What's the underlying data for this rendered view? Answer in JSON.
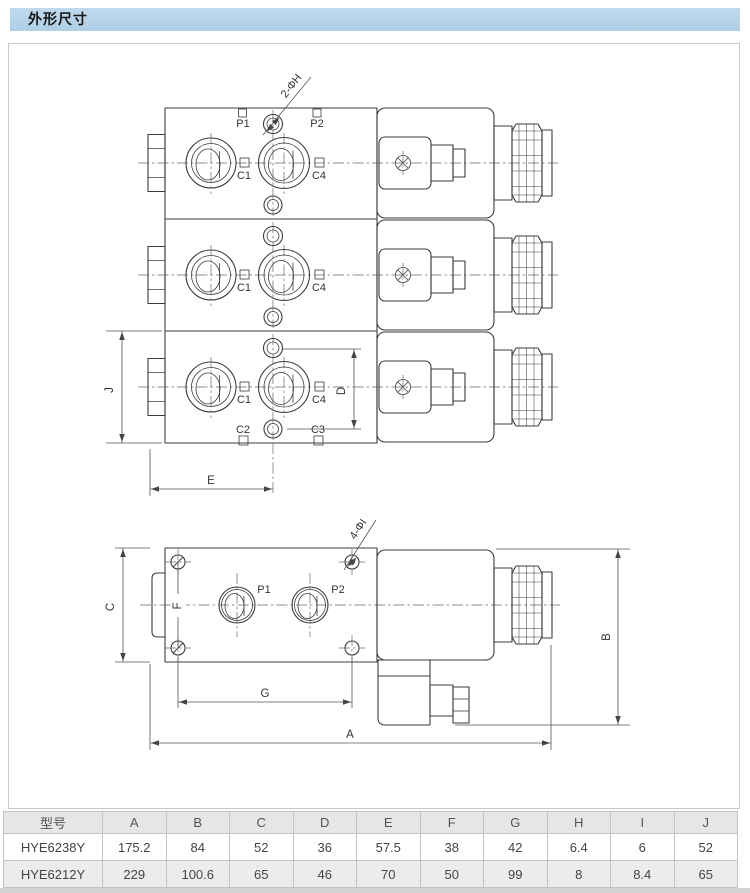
{
  "header": {
    "title": "外形尺寸"
  },
  "drawing": {
    "top": {
      "p1": "P1",
      "p2": "P2",
      "c1": "C1",
      "c2": "C2",
      "c3": "C3",
      "c4": "C4",
      "callout": "2-ΦH",
      "dim_j": "J",
      "dim_d": "D",
      "dim_e": "E"
    },
    "bottom": {
      "p1": "P1",
      "p2": "P2",
      "callout": "4-ΦI",
      "dim_a": "A",
      "dim_b": "B",
      "dim_c": "C",
      "dim_f": "F",
      "dim_g": "G"
    }
  },
  "table": {
    "columns": [
      "型号",
      "A",
      "B",
      "C",
      "D",
      "E",
      "F",
      "G",
      "H",
      "I",
      "J"
    ],
    "rows": [
      [
        "HYE6238Y",
        "175.2",
        "84",
        "52",
        "36",
        "57.5",
        "38",
        "42",
        "6.4",
        "6",
        "52"
      ],
      [
        "HYE6212Y",
        "229",
        "100.6",
        "65",
        "46",
        "70",
        "50",
        "99",
        "8",
        "8.4",
        "65"
      ]
    ]
  }
}
